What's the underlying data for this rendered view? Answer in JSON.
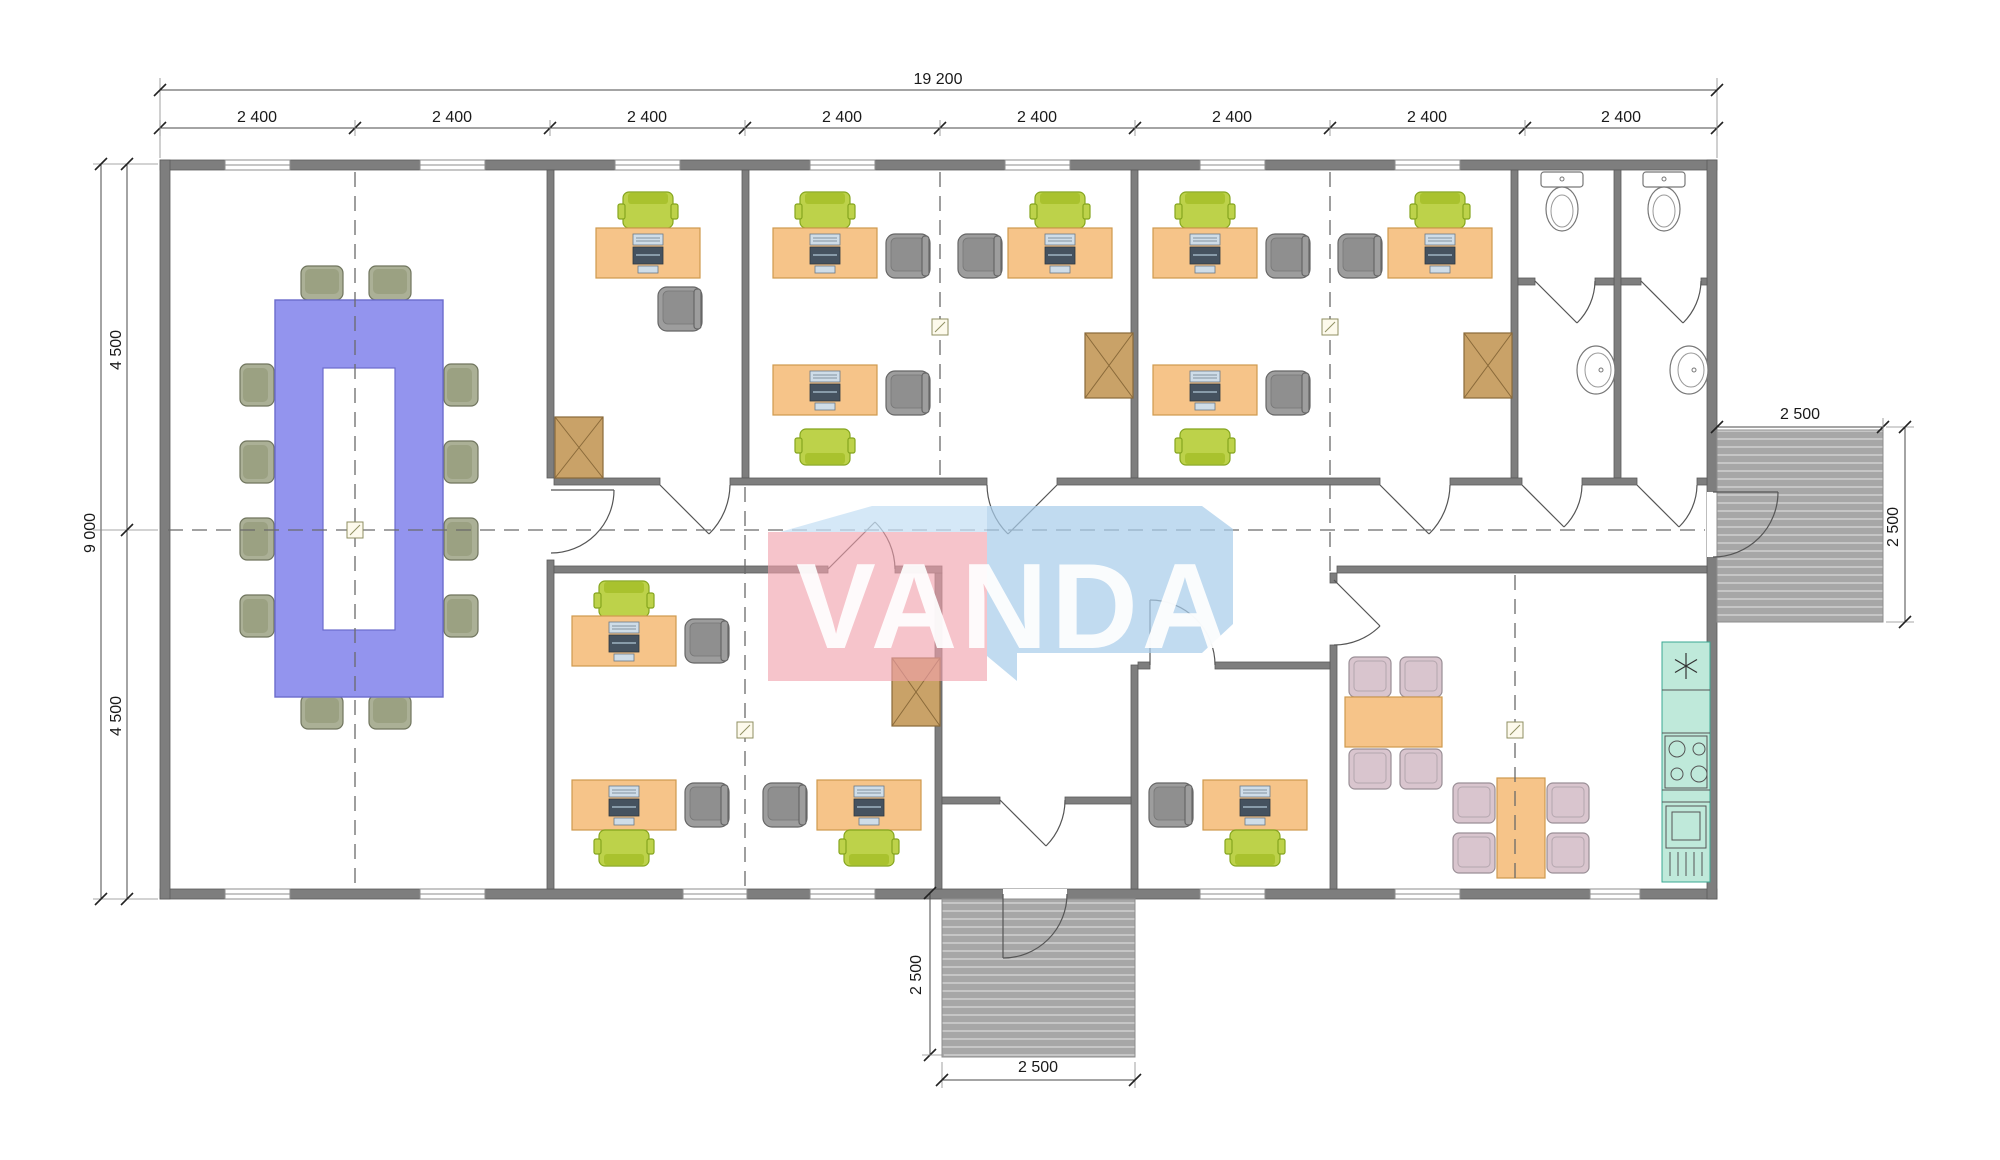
{
  "dimensions": {
    "top_total": "19 200",
    "top_bays": [
      "2 400",
      "2 400",
      "2 400",
      "2 400",
      "2 400",
      "2 400",
      "2 400",
      "2 400"
    ],
    "left_total": "9 000",
    "left_top_half": "4 500",
    "left_bottom_half": "4 500",
    "right_porch_width": "2 500",
    "right_porch_depth": "2 500",
    "bottom_porch_depth": "2 500",
    "bottom_porch_width": "2 500"
  },
  "logo": {
    "text": "VANDA",
    "pink": "#f09fab",
    "blue_band": "#c7e0f4",
    "blue_block": "#a9cdea",
    "text_color": "#ffffff"
  },
  "palette": {
    "wall": "#7e7e7e",
    "desk_orange": "#f6c489",
    "task_chair_green": "#bdd24a",
    "guest_chair_gray": "#9d9d9d",
    "conference_table": "#9394ee",
    "conference_chair": "#abb096",
    "cabinet_tan": "#c9a268",
    "dining_chair": "#d9c5ce",
    "kitchen_counter": "#bfe9da",
    "kitchen_counter_border": "#3aa893",
    "deck_gray": "#a7a7a7"
  }
}
